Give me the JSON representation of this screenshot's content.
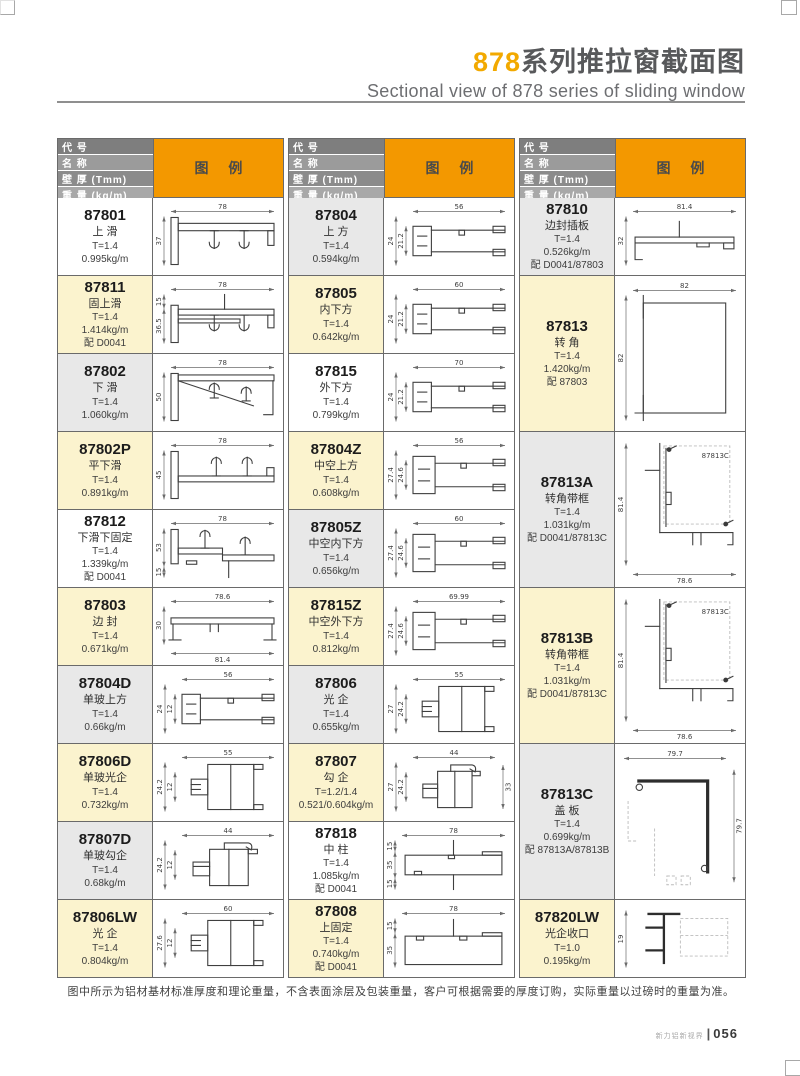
{
  "page": {
    "title_highlight": "878",
    "title_rest": "系列推拉窗截面图",
    "subtitle": "Sectional view of 878 series of sliding window",
    "note": "图中所示为铝材基材标准厚度和理论重量，不含表面涂层及包装重量，客户可根据需要的厚度订购，实际重量以过磅时的重量为准。",
    "footer_brand": "新力铝新视界",
    "footer_separator": "|",
    "footer_page": "056"
  },
  "colors": {
    "accent_orange": "#f39800",
    "title_accent": "#f2a900",
    "title_gray": "#58595b",
    "header_grays": [
      "#7e7e7e",
      "#9b9b9b",
      "#8b8b8b",
      "#a8a8a8"
    ],
    "row_bg": {
      "white": "#ffffff",
      "yellow": "#fbf3ce",
      "gray": "#e8e8e8"
    },
    "grid_border": "#6a6a6a"
  },
  "header": {
    "code": "代 号",
    "name": "名 称",
    "thickness": "壁 厚 (Tmm)",
    "weight": "重 量 (kg/m)",
    "legend": "图 例"
  },
  "columns": [
    {
      "rows": [
        {
          "code": "87801",
          "name": "上 滑",
          "thickness": "T=1.4",
          "weight": "0.995kg/m",
          "bg": "white",
          "shape": "rail",
          "dims": {
            "top": "78",
            "left": [
              "37"
            ]
          }
        },
        {
          "code": "87811",
          "name": "固上滑",
          "thickness": "T=1.4",
          "weight": "1.414kg/m",
          "match": "配 D0041",
          "bg": "yellow",
          "shape": "rail2",
          "dims": {
            "top": "78",
            "left": [
              "15",
              "36.5"
            ],
            "leftMode": "stack"
          }
        },
        {
          "code": "87802",
          "name": "下 滑",
          "thickness": "T=1.4",
          "weight": "1.060kg/m",
          "bg": "gray",
          "shape": "railSlope",
          "dims": {
            "top": "78",
            "left": [
              "50"
            ]
          }
        },
        {
          "code": "87802P",
          "name": "平下滑",
          "thickness": "T=1.4",
          "weight": "0.891kg/m",
          "bg": "yellow",
          "shape": "railFlat",
          "dims": {
            "top": "78",
            "left": [
              "45"
            ]
          }
        },
        {
          "code": "87812",
          "name": "下滑下固定",
          "thickness": "T=1.4",
          "weight": "1.339kg/m",
          "match": "配 D0041",
          "bg": "white",
          "shape": "railStep",
          "dims": {
            "top": "78",
            "left": [
              "53",
              "15"
            ],
            "leftMode": "stack"
          }
        },
        {
          "code": "87803",
          "name": "边 封",
          "thickness": "T=1.4",
          "weight": "0.671kg/m",
          "bg": "yellow",
          "shape": "channel",
          "dims": {
            "top": "78.6",
            "left": [
              "30"
            ],
            "bottom": "81.4"
          }
        },
        {
          "code": "87804D",
          "name": "单玻上方",
          "thickness": "T=1.4",
          "weight": "0.66kg/m",
          "bg": "gray",
          "shape": "bar",
          "dims": {
            "top": "56",
            "left": [
              "24",
              "12"
            ]
          }
        },
        {
          "code": "87806D",
          "name": "单玻光企",
          "thickness": "T=1.4",
          "weight": "0.732kg/m",
          "bg": "yellow",
          "shape": "box",
          "dims": {
            "top": "55",
            "left": [
              "24.2",
              "12"
            ]
          }
        },
        {
          "code": "87807D",
          "name": "单玻勾企",
          "thickness": "T=1.4",
          "weight": "0.68kg/m",
          "bg": "gray",
          "shape": "boxHook",
          "dims": {
            "top": "44",
            "left": [
              "24.2",
              "12"
            ]
          }
        },
        {
          "code": "87806LW",
          "name": "光 企",
          "thickness": "T=1.4",
          "weight": "0.804kg/m",
          "bg": "yellow",
          "shape": "box",
          "dims": {
            "top": "60",
            "left": [
              "27.6",
              "12"
            ]
          }
        }
      ]
    },
    {
      "rows": [
        {
          "code": "87804",
          "name": "上 方",
          "thickness": "T=1.4",
          "weight": "0.594kg/m",
          "bg": "gray",
          "shape": "bar",
          "dims": {
            "top": "56",
            "left": [
              "24",
              "21.2"
            ]
          }
        },
        {
          "code": "87805",
          "name": "内下方",
          "thickness": "T=1.4",
          "weight": "0.642kg/m",
          "bg": "yellow",
          "shape": "bar",
          "dims": {
            "top": "60",
            "left": [
              "24",
              "21.2"
            ]
          }
        },
        {
          "code": "87815",
          "name": "外下方",
          "thickness": "T=1.4",
          "weight": "0.799kg/m",
          "bg": "white",
          "shape": "bar",
          "dims": {
            "top": "70",
            "left": [
              "24",
              "21.2"
            ]
          }
        },
        {
          "code": "87804Z",
          "name": "中空上方",
          "thickness": "T=1.4",
          "weight": "0.608kg/m",
          "bg": "yellow",
          "shape": "barZ",
          "dims": {
            "top": "56",
            "left": [
              "27.4",
              "24.6"
            ]
          }
        },
        {
          "code": "87805Z",
          "name": "中空内下方",
          "thickness": "T=1.4",
          "weight": "0.656kg/m",
          "bg": "gray",
          "shape": "barZ",
          "dims": {
            "top": "60",
            "left": [
              "27.4",
              "24.6"
            ]
          }
        },
        {
          "code": "87815Z",
          "name": "中空外下方",
          "thickness": "T=1.4",
          "weight": "0.812kg/m",
          "bg": "yellow",
          "shape": "barZ",
          "dims": {
            "top": "69.99",
            "left": [
              "27.4",
              "24.6"
            ]
          }
        },
        {
          "code": "87806",
          "name": "光 企",
          "thickness": "T=1.4",
          "weight": "0.655kg/m",
          "bg": "gray",
          "shape": "box",
          "dims": {
            "top": "55",
            "left": [
              "27",
              "24.2"
            ]
          }
        },
        {
          "code": "87807",
          "name": "勾 企",
          "thickness": "T=1.2/1.4",
          "weight": "0.521/0.604kg/m",
          "bg": "yellow",
          "shape": "boxHook",
          "dims": {
            "top": "44",
            "left": [
              "27",
              "24.2"
            ],
            "right": "33"
          }
        },
        {
          "code": "87818",
          "name": "中 柱",
          "thickness": "T=1.4",
          "weight": "1.085kg/m",
          "match": "配 D0041",
          "bg": "white",
          "shape": "wide2",
          "dims": {
            "top": "78",
            "left": [
              "15",
              "35",
              "15"
            ],
            "leftMode": "stack"
          }
        },
        {
          "code": "87808",
          "name": "上固定",
          "thickness": "T=1.4",
          "weight": "0.740kg/m",
          "match": "配 D0041",
          "bg": "yellow",
          "shape": "wide1",
          "dims": {
            "top": "78",
            "left": [
              "15",
              "35"
            ],
            "leftMode": "stack"
          }
        }
      ]
    },
    {
      "rows": [
        {
          "code": "87810",
          "name": "边封插板",
          "thickness": "T=1.4",
          "weight": "0.526kg/m",
          "match": "配 D0041/87803",
          "bg": "gray",
          "span": 1,
          "shape": "plate",
          "dims": {
            "top": "81.4",
            "left": [
              "32"
            ]
          }
        },
        {
          "code": "87813",
          "name": "转 角",
          "thickness": "T=1.4",
          "weight": "1.420kg/m",
          "match": "配 87803",
          "bg": "yellow",
          "span": 2,
          "shape": "square",
          "dims": {
            "top": "82",
            "left": [
              "82"
            ]
          }
        },
        {
          "code": "87813A",
          "name": "转角带框",
          "thickness": "T=1.4",
          "weight": "1.031kg/m",
          "match": "配 D0041/87813C",
          "bg": "gray",
          "span": 2,
          "shape": "corner",
          "dims": {
            "left": [
              "81.4"
            ],
            "bottom": "78.6",
            "inner": "87813C"
          }
        },
        {
          "code": "87813B",
          "name": "转角带框",
          "thickness": "T=1.4",
          "weight": "1.031kg/m",
          "match": "配 D0041/87813C",
          "bg": "yellow",
          "span": 2,
          "shape": "corner",
          "dims": {
            "left": [
              "81.4"
            ],
            "bottom": "78.6",
            "inner": "87813C"
          }
        },
        {
          "code": "87813C",
          "name": "盖 板",
          "thickness": "T=1.4",
          "weight": "0.699kg/m",
          "match": "配 87813A/87813B",
          "bg": "gray",
          "span": 2,
          "shape": "cap",
          "dims": {
            "top": "79.7",
            "right": "79.7"
          }
        },
        {
          "code": "87820LW",
          "name": "光企收口",
          "thickness": "T=1.0",
          "weight": "0.195kg/m",
          "bg": "yellow",
          "span": 1,
          "shape": "clip",
          "dims": {
            "left": [
              "19"
            ]
          }
        }
      ]
    }
  ]
}
